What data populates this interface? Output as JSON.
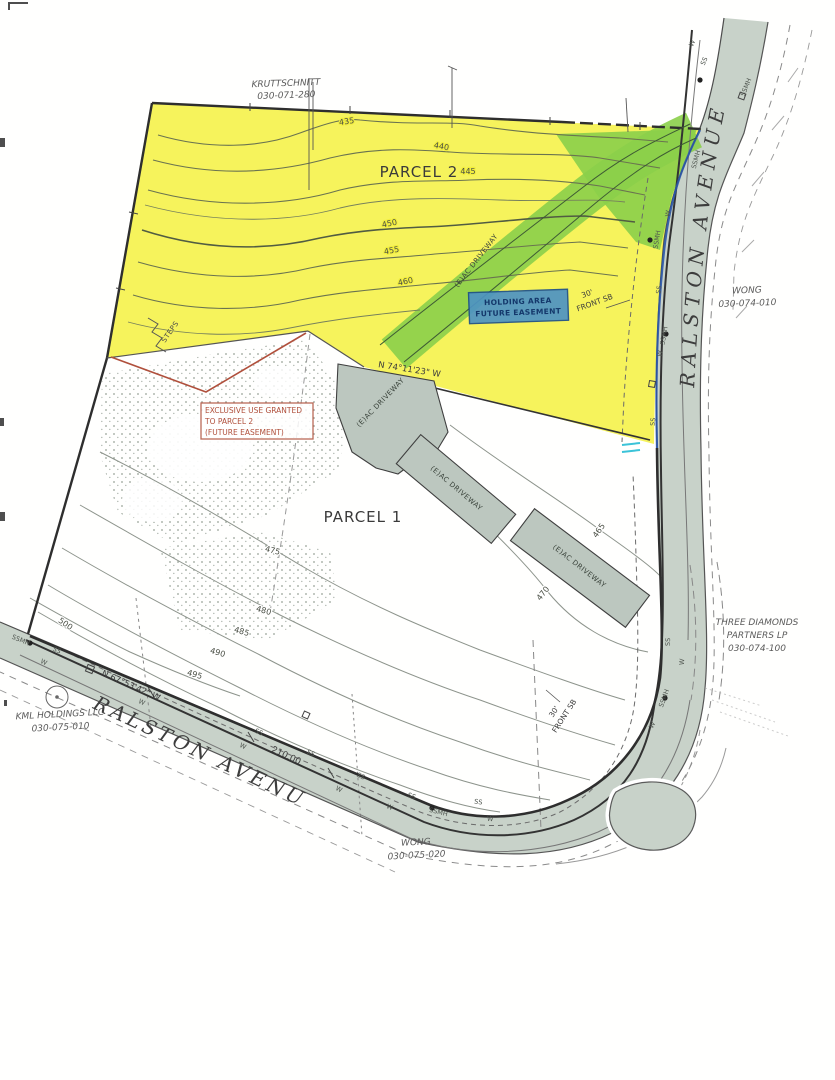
{
  "map": {
    "owners": {
      "northwest": {
        "name": "KRUTTSCHNITT",
        "apn": "030-071-280"
      },
      "east": {
        "name": "WONG",
        "apn": "030-074-010"
      },
      "southeast": {
        "line1": "THREE DIAMONDS",
        "line2": "PARTNERS LP",
        "apn": "030-074-100"
      },
      "southwest": {
        "name": "KML HOLDINGS LLC",
        "apn": "030-075-010"
      },
      "south": {
        "name": "WONG",
        "apn": "030-075-020"
      }
    },
    "parcels": {
      "parcel1": "PARCEL 1",
      "parcel2": "PARCEL 2"
    },
    "street": {
      "name": "RALSTON AVENUE"
    },
    "bearings": {
      "northeast": "N 74°11'23\" W",
      "southwest": "N 67°53'42\" W"
    },
    "distances": {
      "southwest": "210.00"
    },
    "setback": {
      "depth": "30'",
      "label": "FRONT SB"
    },
    "features": {
      "steps": "STEPS",
      "driveway": "(E)AC DRIVEWAY"
    },
    "easements": {
      "blue": {
        "line1": "HOLDING AREA",
        "line2": "FUTURE EASEMENT"
      },
      "red": {
        "line1": "EXCLUSIVE USE GRANTED",
        "line2": "TO PARCEL 2",
        "line3": "(FUTURE EASEMENT)"
      }
    },
    "contours": {
      "c435": "435",
      "c440": "440",
      "c445": "445",
      "c450": "450",
      "c455": "455",
      "c460": "460",
      "c465": "465",
      "c470": "470",
      "c475": "475",
      "c480": "480",
      "c485": "485",
      "c490": "490",
      "c495": "495",
      "c500": "500"
    },
    "utilities": {
      "sewer": "SS",
      "water": "W",
      "manhole": "SSMH"
    },
    "colors": {
      "parcel2_highlight": "#f4ef2e",
      "driveway_highlight": "#8bcf4a",
      "easement_highlight": "#4d93c4",
      "annotation_red": "#b0503c",
      "road_fill": "#c8d2c9",
      "frontage_blue": "#2a55a8"
    }
  }
}
